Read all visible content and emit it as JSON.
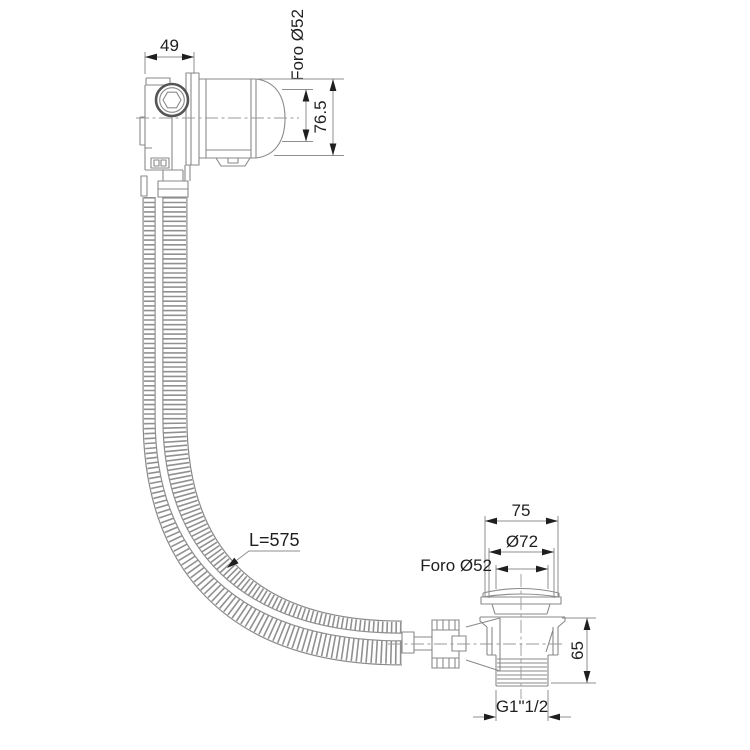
{
  "drawing": {
    "background": "#ffffff",
    "part_line_color": "#8a8a8a",
    "dimension_text_color": "#1f1f1f",
    "overflow_fitting": {
      "width": "49",
      "hole": "Foro Ø52",
      "height": "76.5"
    },
    "hose": {
      "length": "L=575"
    },
    "drain_fitting": {
      "overall_width": "75",
      "cap_diameter": "Ø72",
      "hole": "Foro Ø52",
      "height": "65",
      "thread": "G1\"1/2"
    }
  }
}
